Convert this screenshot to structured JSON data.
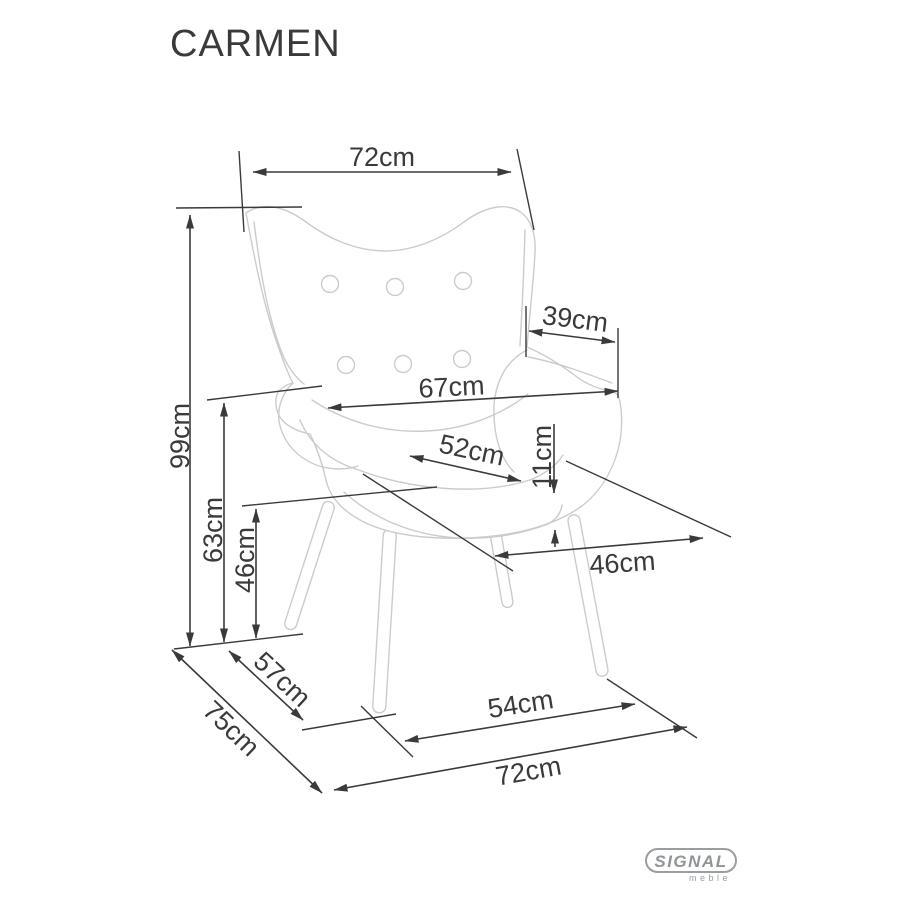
{
  "title": "CARMEN",
  "product": {
    "type": "wingback armchair technical dimension drawing",
    "view": "three-quarter isometric sketch"
  },
  "labels": {
    "top_width": "72cm",
    "overall_height": "99cm",
    "wing_depth": "39cm",
    "backrest_width": "67cm",
    "seat_width": "52cm",
    "cushion_thickness": "11cm",
    "armrest_height": "63cm",
    "seat_height": "46cm",
    "seat_depth": "46cm",
    "side_span": "57cm",
    "overall_depth": "75cm",
    "front_leg_span": "54cm",
    "base_width": "72cm"
  },
  "logo": {
    "brand": "SIGNAL",
    "sub": "meble"
  },
  "colors": {
    "ink": "#3a3a3a",
    "sketch_line": "#c9cccf",
    "logo_gray": "#93989b",
    "background": "#ffffff"
  }
}
